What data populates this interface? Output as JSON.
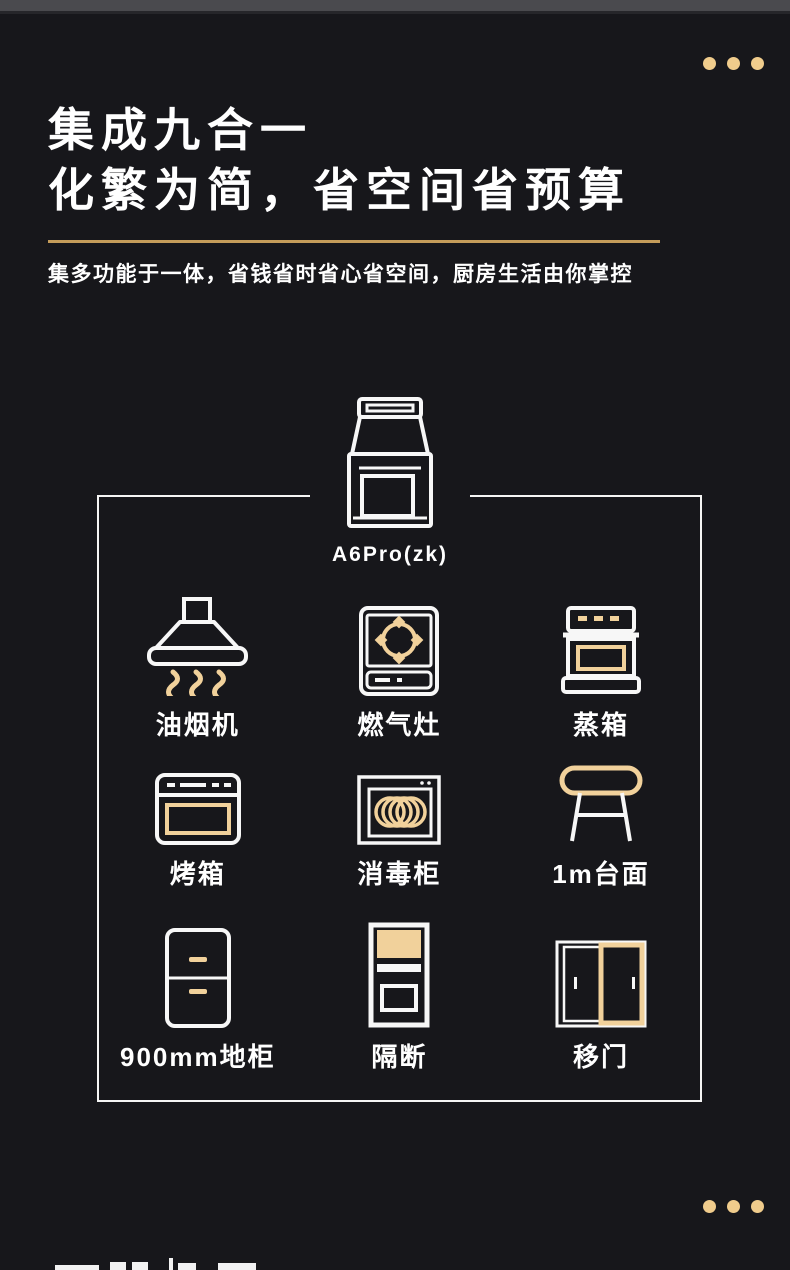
{
  "page": {
    "background": "#17171b",
    "topbar_color": "#4a4a4e",
    "accent_gold": "#f1d19b",
    "rule_gold": "#c49c5a",
    "dot_gold": "#f0cc8c",
    "text_color": "#ffffff"
  },
  "header": {
    "title_line1": "集成九合一",
    "title_line2": "化繁为简，省空间省预算",
    "subtitle": "集多功能于一体，省钱省时省心省空间，厨房生活由你掌控"
  },
  "product": {
    "model_label": "A6Pro(zk)",
    "icon": "integrated-stove-icon"
  },
  "features": [
    {
      "label": "油烟机",
      "icon": "range-hood-icon"
    },
    {
      "label": "燃气灶",
      "icon": "gas-stove-icon"
    },
    {
      "label": "蒸箱",
      "icon": "steam-oven-icon"
    },
    {
      "label": "烤箱",
      "icon": "oven-icon"
    },
    {
      "label": "消毒柜",
      "icon": "disinfection-cabinet-icon"
    },
    {
      "label": "1m台面",
      "icon": "countertop-icon"
    },
    {
      "label": "900mm地柜",
      "icon": "floor-cabinet-icon"
    },
    {
      "label": "隔断",
      "icon": "partition-icon"
    },
    {
      "label": "移门",
      "icon": "sliding-door-icon"
    }
  ],
  "decor": {
    "top_dots": 3,
    "bottom_dots": 3,
    "next_section_text_cropped": true
  }
}
